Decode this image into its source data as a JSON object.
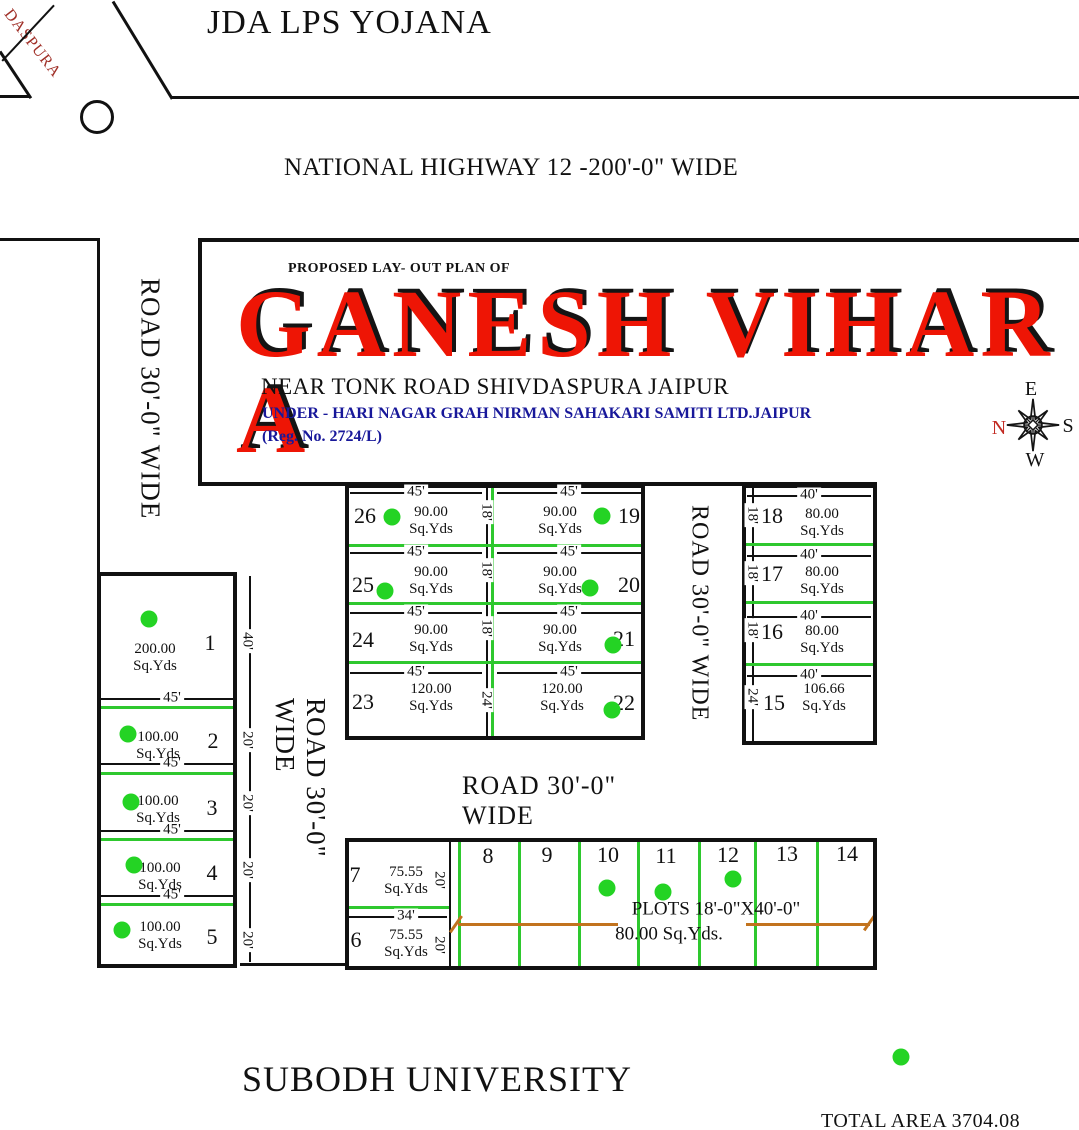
{
  "header": {
    "scheme": "JDA LPS YOJANA",
    "highway": "NATIONAL HIGHWAY 12 -200'-0\" WIDE",
    "corner": "DASPURA"
  },
  "title_block": {
    "caption": "PROPOSED LAY- OUT PLAN OF",
    "name": "GANESH VIHAR A",
    "location": "NEAR TONK ROAD SHIVDASPURA  JAIPUR",
    "society": "UNDER - HARI NAGAR GRAH NIRMAN SAHAKARI SAMITI LTD.JAIPUR",
    "reg": "(Reg. No. 2724/L)"
  },
  "footer": {
    "university": "SUBODH UNIVERSITY",
    "total_area": "TOTAL AREA 3704.08 SQ.YD"
  },
  "theme": {
    "ink": "#111111",
    "green": "#2ec82e",
    "dot_green": "#24d324",
    "orange": "#c2731e",
    "title_red": "#ee1505",
    "blue": "#18189a",
    "corner_red": "#a03028",
    "compass_north_red": "#c22a22"
  },
  "compass": {
    "letters": [
      {
        "x": 1031,
        "y": 389,
        "t": "E"
      },
      {
        "x": 1068,
        "y": 426,
        "t": "S"
      },
      {
        "x": 1035,
        "y": 460,
        "t": "W"
      },
      {
        "x": 999,
        "y": 428,
        "t": "N",
        "red": 1
      }
    ]
  },
  "plan": {
    "area_unit": "Sq.Yds",
    "roads": [
      {
        "x": 130,
        "y": 266,
        "w": 40,
        "h": 266,
        "t": "ROAD 30'-0\" WIDE",
        "s": 27
      },
      {
        "x": 280,
        "y": 698,
        "w": 40,
        "h": 236,
        "t": "ROAD 30'-0\" WIDE",
        "s": 27
      },
      {
        "x": 681,
        "y": 496,
        "w": 36,
        "h": 234,
        "t": "ROAD 30'-0\" WIDE",
        "s": 24
      },
      {
        "x": 462,
        "y": 783,
        "w": 230,
        "h": 36,
        "t": "ROAD 30'-0\" WIDE",
        "s": 26,
        "hz": 1
      }
    ],
    "rects": [
      {
        "x": 97,
        "y": 572,
        "w": 140,
        "h": 396,
        "t": 4
      },
      {
        "x": 345,
        "y": 484,
        "w": 300,
        "h": 256,
        "t": 4
      },
      {
        "x": 742,
        "y": 484,
        "w": 135,
        "h": 261,
        "t": 4
      },
      {
        "x": 345,
        "y": 838,
        "w": 532,
        "h": 132,
        "t": 4
      }
    ],
    "circles": [
      {
        "x": 80,
        "y": 100,
        "d": 34
      }
    ],
    "lines": [
      {
        "x": 172,
        "y": 96,
        "l": 907,
        "t": 3,
        "c": "k"
      },
      {
        "x": 113,
        "y": 0,
        "l": 114,
        "t": 3,
        "c": "k",
        "d": 58.7
      },
      {
        "x": 0,
        "y": 50,
        "l": 56,
        "t": 3,
        "c": "k",
        "d": 56.5
      },
      {
        "x": 0,
        "y": 95,
        "l": 30,
        "t": 3,
        "c": "k"
      },
      {
        "x": 2,
        "y": 60,
        "l": 76,
        "t": 1.5,
        "c": "k",
        "d": -47
      },
      {
        "x": 0,
        "y": 238,
        "l": 100,
        "t": 3,
        "c": "k"
      },
      {
        "x": 97,
        "y": 240,
        "l": 336,
        "t": 3,
        "c": "k",
        "v": 1
      },
      {
        "x": 198,
        "y": 238,
        "l": 881,
        "t": 4,
        "c": "k"
      },
      {
        "x": 198,
        "y": 240,
        "l": 246,
        "t": 4,
        "c": "k",
        "v": 1
      },
      {
        "x": 198,
        "y": 482,
        "l": 679,
        "t": 4,
        "c": "k"
      },
      {
        "x": 240,
        "y": 963,
        "l": 105,
        "t": 3,
        "c": "k"
      },
      {
        "x": 449,
        "y": 840,
        "l": 128,
        "t": 2,
        "c": "k",
        "v": 1
      },
      {
        "x": 249,
        "y": 576,
        "l": 386,
        "t": 1.5,
        "c": "k",
        "v": 1
      },
      {
        "x": 486,
        "y": 486,
        "l": 252,
        "t": 1.5,
        "c": "k",
        "v": 1
      },
      {
        "x": 752,
        "y": 486,
        "l": 258,
        "t": 1.5,
        "c": "k",
        "v": 1
      },
      {
        "x": 99,
        "y": 698,
        "l": 138,
        "t": 1.5,
        "c": "k"
      },
      {
        "x": 99,
        "y": 763,
        "l": 138,
        "t": 1.5,
        "c": "k"
      },
      {
        "x": 99,
        "y": 830,
        "l": 138,
        "t": 1.5,
        "c": "k"
      },
      {
        "x": 99,
        "y": 895,
        "l": 138,
        "t": 1.5,
        "c": "k"
      },
      {
        "x": 350,
        "y": 492,
        "l": 132,
        "t": 1.5,
        "c": "k"
      },
      {
        "x": 497,
        "y": 492,
        "l": 145,
        "t": 1.5,
        "c": "k"
      },
      {
        "x": 350,
        "y": 552,
        "l": 132,
        "t": 1.5,
        "c": "k"
      },
      {
        "x": 497,
        "y": 552,
        "l": 145,
        "t": 1.5,
        "c": "k"
      },
      {
        "x": 350,
        "y": 612,
        "l": 132,
        "t": 1.5,
        "c": "k"
      },
      {
        "x": 497,
        "y": 612,
        "l": 145,
        "t": 1.5,
        "c": "k"
      },
      {
        "x": 350,
        "y": 672,
        "l": 132,
        "t": 1.5,
        "c": "k"
      },
      {
        "x": 497,
        "y": 672,
        "l": 145,
        "t": 1.5,
        "c": "k"
      },
      {
        "x": 747,
        "y": 495,
        "l": 124,
        "t": 1.5,
        "c": "k"
      },
      {
        "x": 747,
        "y": 555,
        "l": 124,
        "t": 1.5,
        "c": "k"
      },
      {
        "x": 747,
        "y": 616,
        "l": 124,
        "t": 1.5,
        "c": "k"
      },
      {
        "x": 747,
        "y": 675,
        "l": 124,
        "t": 1.5,
        "c": "k"
      },
      {
        "x": 347,
        "y": 916,
        "l": 100,
        "t": 1.5,
        "c": "k"
      },
      {
        "x": 99,
        "y": 706,
        "l": 138,
        "t": 3,
        "c": "g"
      },
      {
        "x": 99,
        "y": 772,
        "l": 138,
        "t": 3,
        "c": "g"
      },
      {
        "x": 99,
        "y": 838,
        "l": 138,
        "t": 3,
        "c": "g"
      },
      {
        "x": 99,
        "y": 903,
        "l": 138,
        "t": 3,
        "c": "g"
      },
      {
        "x": 347,
        "y": 544,
        "l": 296,
        "t": 3,
        "c": "g"
      },
      {
        "x": 347,
        "y": 602,
        "l": 296,
        "t": 3,
        "c": "g"
      },
      {
        "x": 347,
        "y": 661,
        "l": 296,
        "t": 3,
        "c": "g"
      },
      {
        "x": 491,
        "y": 486,
        "l": 252,
        "t": 3,
        "c": "g",
        "v": 1
      },
      {
        "x": 744,
        "y": 543,
        "l": 131,
        "t": 3,
        "c": "g"
      },
      {
        "x": 744,
        "y": 601,
        "l": 131,
        "t": 3,
        "c": "g"
      },
      {
        "x": 744,
        "y": 663,
        "l": 131,
        "t": 3,
        "c": "g"
      },
      {
        "x": 458,
        "y": 840,
        "l": 128,
        "t": 3,
        "c": "g",
        "v": 1
      },
      {
        "x": 518,
        "y": 840,
        "l": 128,
        "t": 3,
        "c": "g",
        "v": 1
      },
      {
        "x": 578,
        "y": 840,
        "l": 128,
        "t": 3,
        "c": "g",
        "v": 1
      },
      {
        "x": 637,
        "y": 840,
        "l": 128,
        "t": 3,
        "c": "g",
        "v": 1
      },
      {
        "x": 698,
        "y": 840,
        "l": 128,
        "t": 3,
        "c": "g",
        "v": 1
      },
      {
        "x": 754,
        "y": 840,
        "l": 128,
        "t": 3,
        "c": "g",
        "v": 1
      },
      {
        "x": 816,
        "y": 840,
        "l": 128,
        "t": 3,
        "c": "g",
        "v": 1
      },
      {
        "x": 347,
        "y": 906,
        "l": 102,
        "t": 3,
        "c": "g"
      },
      {
        "x": 458,
        "y": 923,
        "l": 160,
        "t": 2.5,
        "c": "o"
      },
      {
        "x": 746,
        "y": 923,
        "l": 124,
        "t": 2.5,
        "c": "o"
      },
      {
        "x": 450,
        "y": 931,
        "l": 20,
        "t": 2.5,
        "c": "o",
        "d": -55
      },
      {
        "x": 864,
        "y": 929,
        "l": 20,
        "t": 2.5,
        "c": "o",
        "d": -55
      }
    ],
    "dims": [
      {
        "x": 172,
        "y": 698,
        "t": "45'"
      },
      {
        "x": 172,
        "y": 763,
        "t": "45'"
      },
      {
        "x": 172,
        "y": 830,
        "t": "45'"
      },
      {
        "x": 172,
        "y": 895,
        "t": "45'"
      },
      {
        "x": 247,
        "y": 641,
        "t": "40'",
        "r": 90
      },
      {
        "x": 247,
        "y": 740,
        "t": "20'",
        "r": 90
      },
      {
        "x": 247,
        "y": 803,
        "t": "20'",
        "r": 90
      },
      {
        "x": 247,
        "y": 870,
        "t": "20'",
        "r": 90
      },
      {
        "x": 247,
        "y": 940,
        "t": "20'",
        "r": 90
      },
      {
        "x": 416,
        "y": 492,
        "t": "45'"
      },
      {
        "x": 569,
        "y": 492,
        "t": "45'"
      },
      {
        "x": 416,
        "y": 552,
        "t": "45'"
      },
      {
        "x": 569,
        "y": 552,
        "t": "45'"
      },
      {
        "x": 416,
        "y": 612,
        "t": "45'"
      },
      {
        "x": 569,
        "y": 612,
        "t": "45'"
      },
      {
        "x": 416,
        "y": 672,
        "t": "45'"
      },
      {
        "x": 569,
        "y": 672,
        "t": "45'"
      },
      {
        "x": 486,
        "y": 512,
        "t": "18'",
        "r": 90
      },
      {
        "x": 486,
        "y": 570,
        "t": "18'",
        "r": 90
      },
      {
        "x": 486,
        "y": 628,
        "t": "18'",
        "r": 90
      },
      {
        "x": 486,
        "y": 700,
        "t": "24'",
        "r": 90
      },
      {
        "x": 809,
        "y": 495,
        "t": "40'"
      },
      {
        "x": 809,
        "y": 555,
        "t": "40'"
      },
      {
        "x": 809,
        "y": 616,
        "t": "40'"
      },
      {
        "x": 809,
        "y": 675,
        "t": "40'"
      },
      {
        "x": 752,
        "y": 515,
        "t": "18'",
        "r": 90
      },
      {
        "x": 752,
        "y": 573,
        "t": "18'",
        "r": 90
      },
      {
        "x": 752,
        "y": 630,
        "t": "18'",
        "r": 90
      },
      {
        "x": 752,
        "y": 697,
        "t": "24'",
        "r": 90
      },
      {
        "x": 406,
        "y": 916,
        "t": "34'"
      },
      {
        "x": 439,
        "y": 880,
        "t": "20'",
        "r": 90
      },
      {
        "x": 439,
        "y": 945,
        "t": "20'",
        "r": 90
      }
    ],
    "numbers": [
      {
        "x": 210,
        "y": 643,
        "t": "1"
      },
      {
        "x": 213,
        "y": 741,
        "t": "2"
      },
      {
        "x": 212,
        "y": 808,
        "t": "3"
      },
      {
        "x": 212,
        "y": 873,
        "t": "4"
      },
      {
        "x": 212,
        "y": 937,
        "t": "5"
      },
      {
        "x": 356,
        "y": 940,
        "t": "6"
      },
      {
        "x": 355,
        "y": 875,
        "t": "7"
      },
      {
        "x": 488,
        "y": 856,
        "t": "8"
      },
      {
        "x": 547,
        "y": 855,
        "t": "9"
      },
      {
        "x": 608,
        "y": 855,
        "t": "10"
      },
      {
        "x": 666,
        "y": 856,
        "t": "11"
      },
      {
        "x": 728,
        "y": 855,
        "t": "12"
      },
      {
        "x": 787,
        "y": 854,
        "t": "13"
      },
      {
        "x": 847,
        "y": 854,
        "t": "14"
      },
      {
        "x": 774,
        "y": 703,
        "t": "15"
      },
      {
        "x": 772,
        "y": 632,
        "t": "16"
      },
      {
        "x": 772,
        "y": 574,
        "t": "17"
      },
      {
        "x": 772,
        "y": 516,
        "t": "18"
      },
      {
        "x": 629,
        "y": 516,
        "t": "19"
      },
      {
        "x": 629,
        "y": 585,
        "t": "20"
      },
      {
        "x": 624,
        "y": 639,
        "t": "21"
      },
      {
        "x": 624,
        "y": 703,
        "t": "22"
      },
      {
        "x": 363,
        "y": 702,
        "t": "23"
      },
      {
        "x": 363,
        "y": 640,
        "t": "24"
      },
      {
        "x": 363,
        "y": 585,
        "t": "25"
      },
      {
        "x": 365,
        "y": 516,
        "t": "26"
      }
    ],
    "areas": [
      {
        "x": 155,
        "y": 658,
        "v": "200.00"
      },
      {
        "x": 158,
        "y": 746,
        "v": "100.00"
      },
      {
        "x": 158,
        "y": 810,
        "v": "100.00"
      },
      {
        "x": 160,
        "y": 877,
        "v": "100.00"
      },
      {
        "x": 160,
        "y": 936,
        "v": "100.00"
      },
      {
        "x": 406,
        "y": 881,
        "v": "75.55"
      },
      {
        "x": 406,
        "y": 944,
        "v": "75.55"
      },
      {
        "x": 431,
        "y": 521,
        "v": "90.00"
      },
      {
        "x": 560,
        "y": 521,
        "v": "90.00"
      },
      {
        "x": 431,
        "y": 581,
        "v": "90.00"
      },
      {
        "x": 560,
        "y": 581,
        "v": "90.00"
      },
      {
        "x": 431,
        "y": 639,
        "v": "90.00"
      },
      {
        "x": 560,
        "y": 639,
        "v": "90.00"
      },
      {
        "x": 431,
        "y": 698,
        "v": "120.00"
      },
      {
        "x": 562,
        "y": 698,
        "v": "120.00"
      },
      {
        "x": 822,
        "y": 523,
        "v": "80.00"
      },
      {
        "x": 822,
        "y": 581,
        "v": "80.00"
      },
      {
        "x": 822,
        "y": 640,
        "v": "80.00"
      },
      {
        "x": 824,
        "y": 698,
        "v": "106.66"
      }
    ],
    "captions": [
      {
        "x": 716,
        "y": 909,
        "t": "PLOTS 18'-0\"X40'-0\"",
        "s": 19
      },
      {
        "x": 669,
        "y": 934,
        "t": "80.00 Sq.Yds.",
        "s": 19
      }
    ],
    "dots": [
      {
        "x": 149,
        "y": 619
      },
      {
        "x": 128,
        "y": 734
      },
      {
        "x": 131,
        "y": 802
      },
      {
        "x": 134,
        "y": 865
      },
      {
        "x": 122,
        "y": 930
      },
      {
        "x": 392,
        "y": 517
      },
      {
        "x": 602,
        "y": 516
      },
      {
        "x": 385,
        "y": 591
      },
      {
        "x": 590,
        "y": 588
      },
      {
        "x": 613,
        "y": 645
      },
      {
        "x": 612,
        "y": 710
      },
      {
        "x": 607,
        "y": 888
      },
      {
        "x": 663,
        "y": 892
      },
      {
        "x": 733,
        "y": 879
      },
      {
        "x": 901,
        "y": 1057
      }
    ]
  }
}
